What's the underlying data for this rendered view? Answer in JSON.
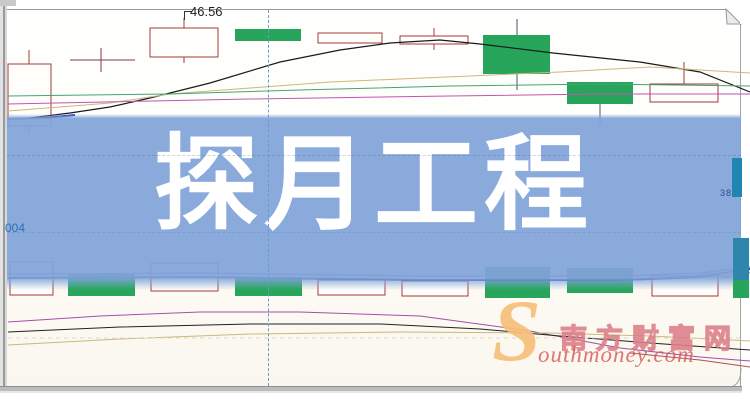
{
  "banner": {
    "title": "探月工程",
    "bg_color": "#80a4d8",
    "text_color": "#ffffff"
  },
  "page": {
    "price_label": "46.56",
    "left_axis_label": "004",
    "right_edge_label": "38"
  },
  "watermark": {
    "swoosh_letter": "S",
    "site_name": "南方财富网",
    "site_domain": "outhmoney.com",
    "accent_color": "#f5be7a",
    "text_color": "#d65858"
  },
  "colors": {
    "up_border": "#a23b3b",
    "up_fill": "#fffefb",
    "down_fill": "#27a55b",
    "down_wick": "#44566b",
    "doji": "#7d3b3b"
  },
  "chart_data": {
    "type": "candlestick",
    "overlay_title": "探月工程",
    "visible_price_label": 46.56,
    "dashed_vline_x": 268,
    "candles": [
      {
        "x": 8,
        "w": 43,
        "top": 64,
        "bottom": 126,
        "fill": "hollow",
        "wick_x": 29,
        "wick_top": 50,
        "wick_bottom": 133
      },
      {
        "x": 70,
        "w": 65,
        "top": 60,
        "bottom": 60,
        "fill": "doji",
        "wick_x": 101,
        "wick_top": 48,
        "wick_bottom": 72
      },
      {
        "x": 150,
        "w": 68,
        "top": 28,
        "bottom": 57,
        "fill": "hollow",
        "wick_x": 184,
        "wick_top": 18,
        "wick_bottom": 63
      },
      {
        "x": 235,
        "w": 66,
        "top": 29,
        "bottom": 41,
        "fill": "solid"
      },
      {
        "x": 318,
        "w": 64,
        "top": 33,
        "bottom": 43,
        "fill": "hollow"
      },
      {
        "x": 400,
        "w": 68,
        "top": 36,
        "bottom": 44,
        "fill": "hollow",
        "wick_x": 434,
        "wick_top": 28,
        "wick_bottom": 50
      },
      {
        "x": 483,
        "w": 67,
        "top": 35,
        "bottom": 74,
        "fill": "solid",
        "wick_x": 517,
        "wick_top": 19,
        "wick_bottom": 90
      },
      {
        "x": 567,
        "w": 66,
        "top": 82,
        "bottom": 104,
        "fill": "solid",
        "wick_x": 600,
        "wick_top": 82,
        "wick_bottom": 125
      },
      {
        "x": 650,
        "w": 68,
        "top": 84,
        "bottom": 102,
        "fill": "hollow",
        "wick_x": 684,
        "wick_top": 62,
        "wick_bottom": 102
      },
      {
        "x": 10,
        "w": 43,
        "top": 262,
        "bottom": 295,
        "fill": "hollow"
      },
      {
        "x": 68,
        "w": 67,
        "top": 274,
        "bottom": 296,
        "fill": "solid"
      },
      {
        "x": 151,
        "w": 67,
        "top": 263,
        "bottom": 291,
        "fill": "hollow"
      },
      {
        "x": 235,
        "w": 67,
        "top": 277,
        "bottom": 296,
        "fill": "solid"
      },
      {
        "x": 318,
        "w": 67,
        "top": 280,
        "bottom": 295,
        "fill": "hollow"
      },
      {
        "x": 402,
        "w": 66,
        "top": 281,
        "bottom": 296,
        "fill": "hollow"
      },
      {
        "x": 485,
        "w": 65,
        "top": 267,
        "bottom": 298,
        "fill": "solid"
      },
      {
        "x": 567,
        "w": 66,
        "top": 268,
        "bottom": 293,
        "fill": "solid"
      },
      {
        "x": 652,
        "w": 66,
        "top": 276,
        "bottom": 296,
        "fill": "hollow"
      }
    ],
    "lines": [
      {
        "name": "ma-black-upper",
        "color": "#1a1a1a",
        "width": 1.2,
        "points": [
          [
            30,
            118
          ],
          [
            70,
            113
          ],
          [
            110,
            107
          ],
          [
            150,
            98
          ],
          [
            210,
            83
          ],
          [
            280,
            62
          ],
          [
            340,
            50
          ],
          [
            390,
            43
          ],
          [
            440,
            40
          ],
          [
            480,
            44
          ],
          [
            553,
            53
          ],
          [
            640,
            62
          ],
          [
            700,
            72
          ],
          [
            750,
            92
          ]
        ]
      },
      {
        "name": "ma-tan-upper",
        "color": "#c9b97c",
        "width": 1,
        "points": [
          [
            8,
            111
          ],
          [
            60,
            107
          ],
          [
            110,
            103
          ],
          [
            170,
            94
          ],
          [
            250,
            88
          ],
          [
            330,
            82
          ],
          [
            400,
            79
          ],
          [
            470,
            76
          ],
          [
            560,
            72
          ],
          [
            650,
            67
          ],
          [
            750,
            73
          ]
        ]
      },
      {
        "name": "ma-green-upper",
        "color": "#46a478",
        "width": 1,
        "points": [
          [
            8,
            96
          ],
          [
            170,
            94
          ],
          [
            300,
            90
          ],
          [
            450,
            86
          ],
          [
            600,
            84
          ],
          [
            750,
            86
          ]
        ]
      },
      {
        "name": "ma-magenta-upper",
        "color": "#c255b0",
        "width": 1,
        "points": [
          [
            8,
            104
          ],
          [
            250,
            99
          ],
          [
            450,
            96
          ],
          [
            600,
            94
          ],
          [
            750,
            94
          ]
        ]
      },
      {
        "name": "ma-blue-upper",
        "color": "#2b3fbf",
        "width": 2,
        "points": [
          [
            8,
            119
          ],
          [
            45,
            118
          ],
          [
            75,
            115
          ]
        ]
      },
      {
        "name": "ma-purple-lower",
        "color": "#7f46a8",
        "width": 1,
        "points": [
          [
            8,
            274
          ],
          [
            200,
            273
          ],
          [
            420,
            276
          ],
          [
            620,
            276
          ],
          [
            700,
            273
          ],
          [
            740,
            268
          ],
          [
            750,
            267
          ]
        ]
      },
      {
        "name": "ma-blue-lower",
        "color": "#2b3fbf",
        "width": 2,
        "points": [
          [
            8,
            278
          ],
          [
            200,
            277
          ],
          [
            420,
            280
          ],
          [
            620,
            280
          ],
          [
            700,
            277
          ],
          [
            735,
            271
          ],
          [
            750,
            269
          ]
        ]
      },
      {
        "name": "ma-red-lower",
        "color": "#c04848",
        "width": 1,
        "points": [
          [
            690,
            277
          ],
          [
            710,
            273
          ],
          [
            725,
            277
          ],
          [
            740,
            271
          ],
          [
            750,
            273
          ]
        ]
      },
      {
        "name": "curve-purple-bottom",
        "color": "#a050a8",
        "width": 1,
        "points": [
          [
            8,
            322
          ],
          [
            100,
            316
          ],
          [
            200,
            312
          ],
          [
            300,
            312
          ],
          [
            420,
            316
          ],
          [
            530,
            331
          ],
          [
            620,
            348
          ],
          [
            700,
            357
          ],
          [
            750,
            361
          ]
        ]
      },
      {
        "name": "curve-black-bottom",
        "color": "#222222",
        "width": 1,
        "points": [
          [
            8,
            332
          ],
          [
            120,
            327
          ],
          [
            250,
            324
          ],
          [
            380,
            324
          ],
          [
            480,
            329
          ],
          [
            560,
            336
          ],
          [
            650,
            343
          ],
          [
            750,
            350
          ]
        ]
      },
      {
        "name": "curve-tan-bottom",
        "color": "#c9b97c",
        "width": 1,
        "points": [
          [
            8,
            345
          ],
          [
            120,
            339
          ],
          [
            250,
            334
          ],
          [
            400,
            332
          ],
          [
            550,
            333
          ],
          [
            650,
            336
          ],
          [
            750,
            341
          ]
        ]
      },
      {
        "name": "curve-darkred-bottom",
        "color": "#b05050",
        "width": 1,
        "points": [
          [
            630,
            353
          ],
          [
            700,
            360
          ],
          [
            750,
            367
          ]
        ]
      },
      {
        "name": "gridline-dashed-bottom",
        "color": "#ded9c8",
        "width": 1,
        "dash": "4 4",
        "points": [
          [
            8,
            338
          ],
          [
            740,
            338
          ]
        ]
      }
    ],
    "overlay_bars": [
      {
        "x": 732,
        "w": 10,
        "top": 158,
        "bottom": 197,
        "color": "#1f86b4"
      },
      {
        "x": 733,
        "w": 16,
        "top": 238,
        "bottom": 280,
        "color": "#2e86ad"
      },
      {
        "x": 733,
        "w": 16,
        "top": 280,
        "bottom": 298,
        "color": "#27a55b"
      }
    ]
  }
}
